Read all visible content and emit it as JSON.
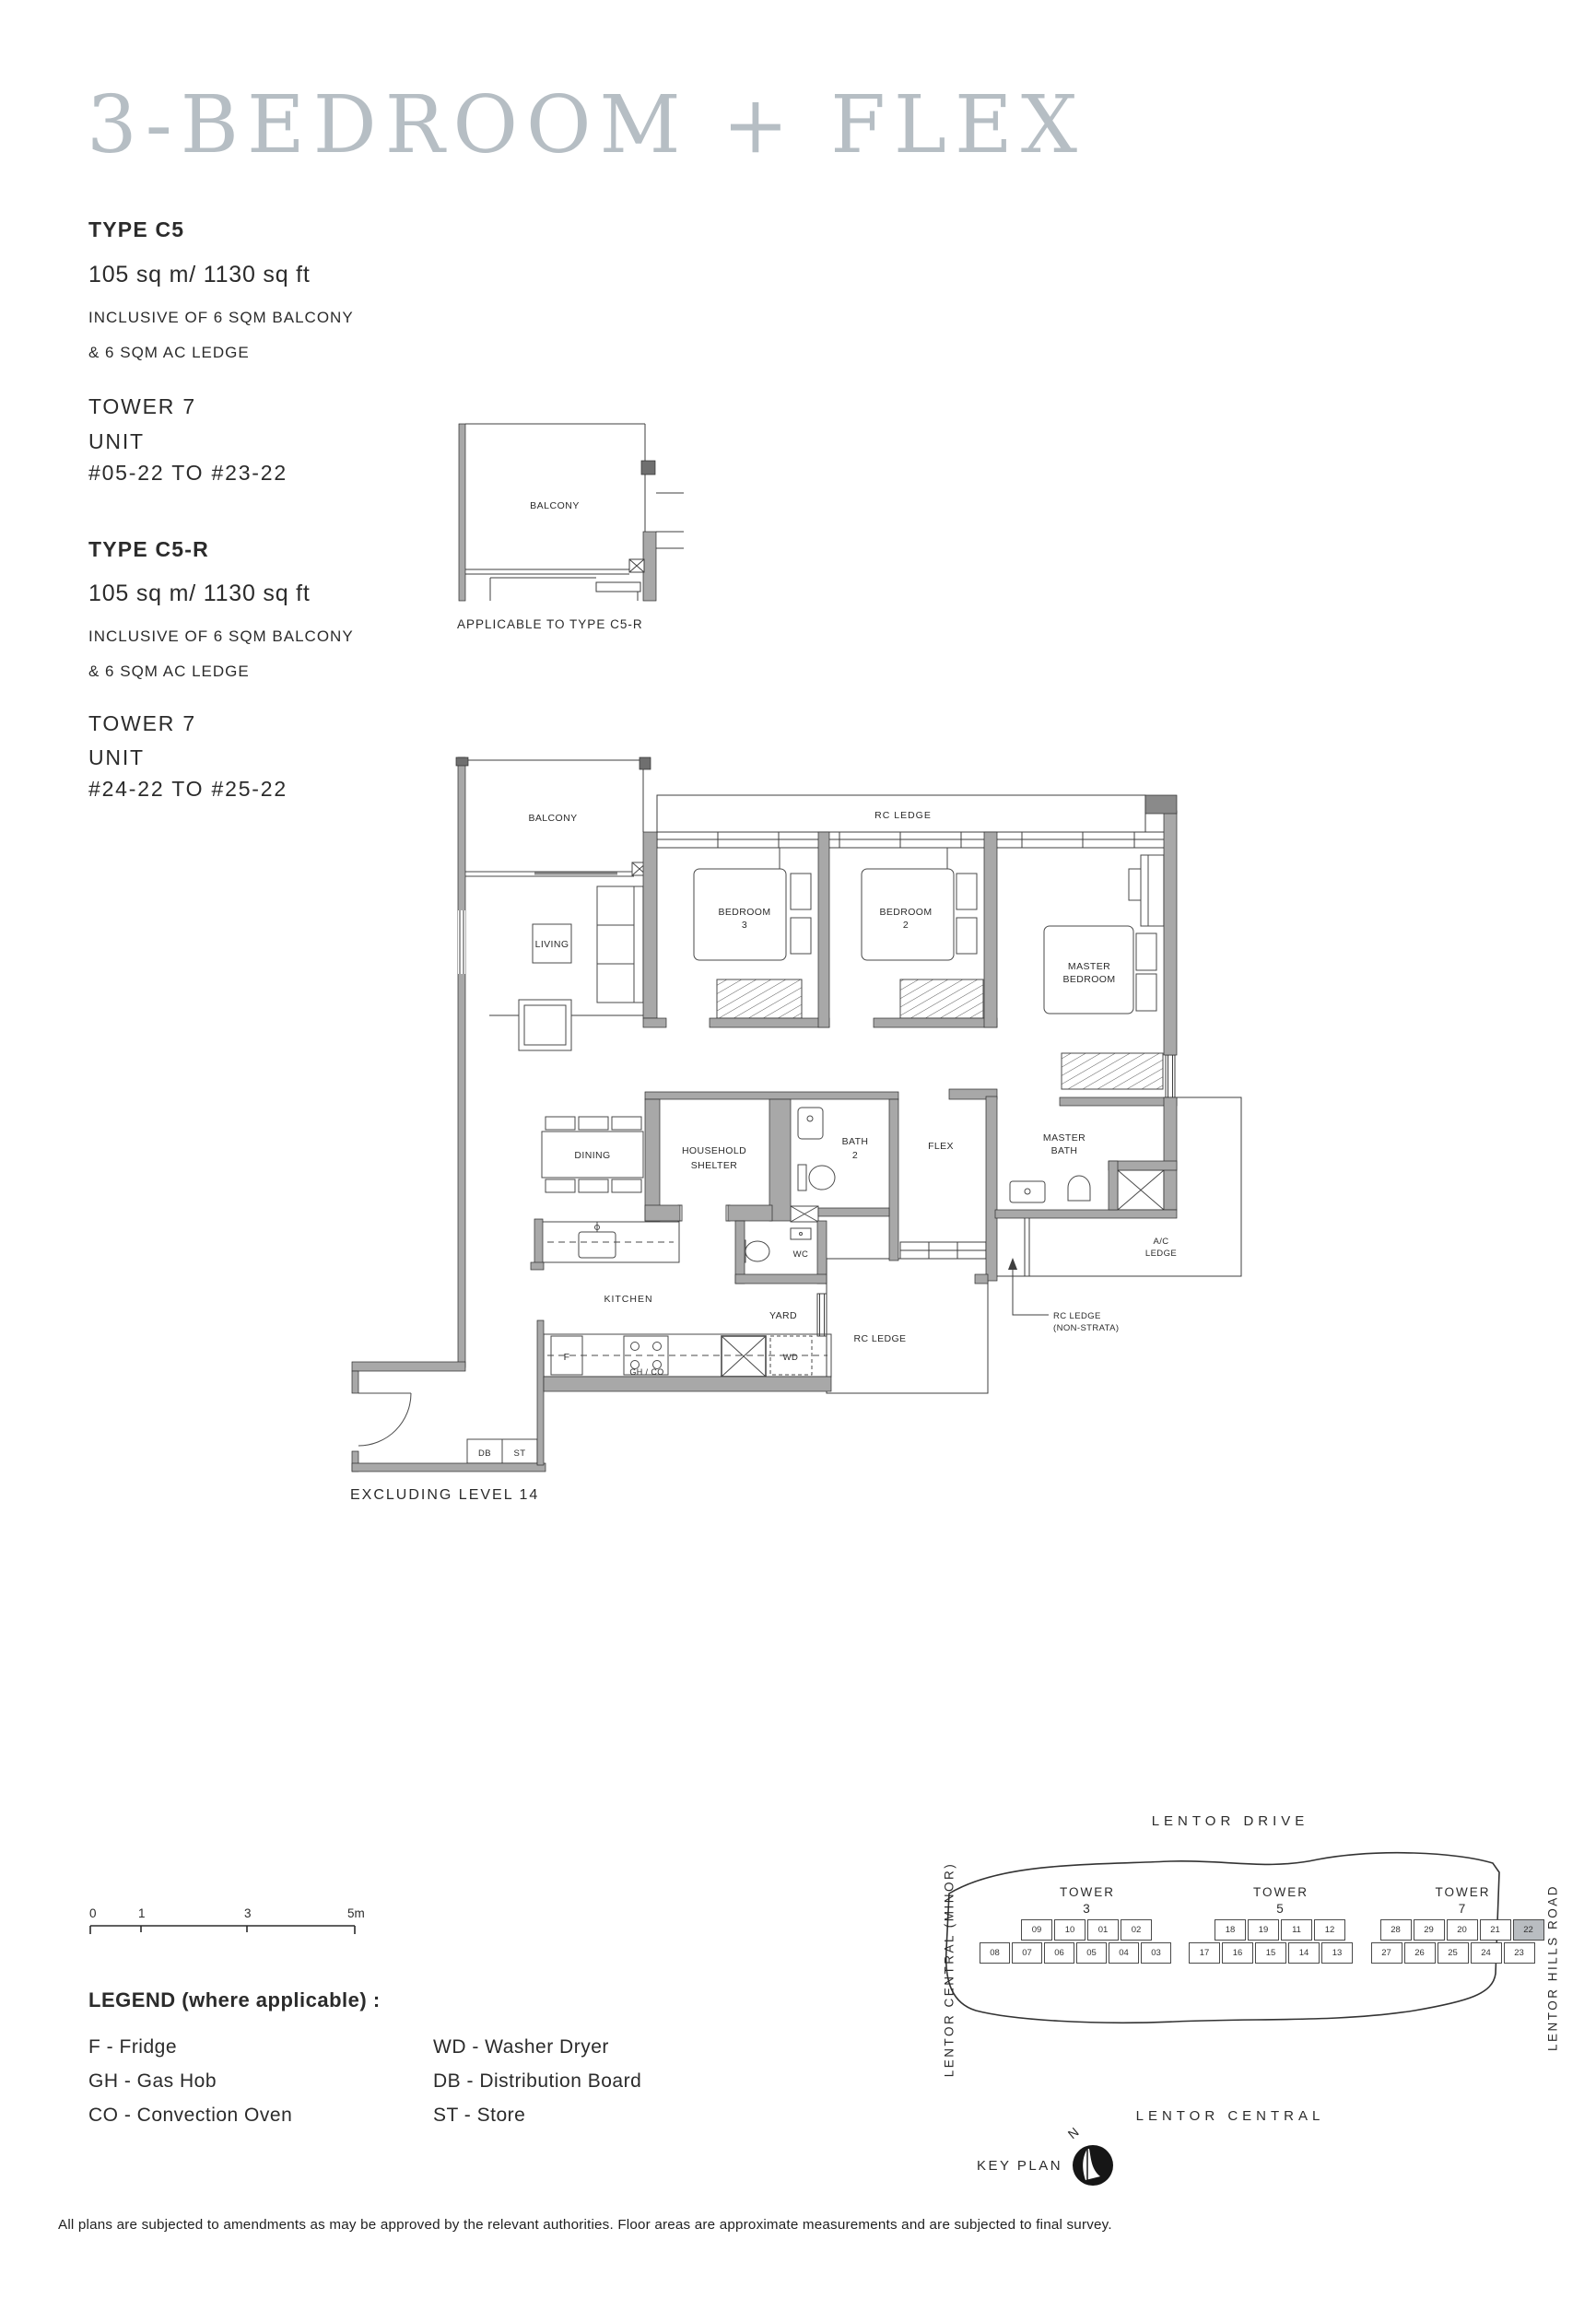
{
  "page": {
    "title": "3-BEDROOM + FLEX",
    "excluding_note": "EXCLUDING LEVEL 14",
    "footer": "All plans are subjected to amendments as may be approved by the relevant authorities. Floor areas are approximate measurements and are subjected to final survey."
  },
  "specs": {
    "c5": {
      "type": "TYPE C5",
      "area": "105 sq m/ 1130 sq ft",
      "inclusive1": "INCLUSIVE OF 6 SQM BALCONY",
      "inclusive2": "& 6 SQM AC LEDGE",
      "tower": "TOWER 7",
      "unit_label": "UNIT",
      "unit_range": "#05-22 TO #23-22"
    },
    "c5r": {
      "type": "TYPE C5-R",
      "area": "105 sq m/ 1130 sq ft",
      "inclusive1": "INCLUSIVE OF 6 SQM BALCONY",
      "inclusive2": "& 6 SQM AC LEDGE",
      "tower": "TOWER 7",
      "unit_label": "UNIT",
      "unit_range": "#24-22 TO #25-22"
    }
  },
  "fragment": {
    "balcony": "BALCONY",
    "caption": "APPLICABLE TO TYPE C5-R"
  },
  "plan": {
    "labels": {
      "balcony": "BALCONY",
      "rc_ledge_top": "RC LEDGE",
      "bedroom3_l1": "BEDROOM",
      "bedroom3_l2": "3",
      "bedroom2_l1": "BEDROOM",
      "bedroom2_l2": "2",
      "master_l1": "MASTER",
      "master_l2": "BEDROOM",
      "living": "LIVING",
      "dining": "DINING",
      "household_l1": "HOUSEHOLD",
      "household_l2": "SHELTER",
      "bath2_l1": "BATH",
      "bath2_l2": "2",
      "flex": "FLEX",
      "masterbath_l1": "MASTER",
      "masterbath_l2": "BATH",
      "ac_l1": "A/C",
      "ac_l2": "LEDGE",
      "wc": "WC",
      "kitchen": "KITCHEN",
      "yard": "YARD",
      "rc_ledge_bottom": "RC LEDGE",
      "rc_ns_l1": "RC LEDGE",
      "rc_ns_l2": "(NON-STRATA)",
      "fridge": "F",
      "ghco": "GH / CO",
      "wd": "WD",
      "db": "DB",
      "st": "ST"
    }
  },
  "scalebar": {
    "t0": "0",
    "t1": "1",
    "t3": "3",
    "t5": "5m"
  },
  "legend": {
    "title": "LEGEND (where applicable) :",
    "col1": [
      "F - Fridge",
      "GH - Gas Hob",
      "CO - Convection Oven"
    ],
    "col2": [
      "WD - Washer Dryer",
      "DB - Distribution Board",
      "ST - Store"
    ]
  },
  "keyplan": {
    "roads": {
      "top": "LENTOR DRIVE",
      "left": "LENTOR CENTRAL (MINOR)",
      "right": "LENTOR HILLS ROAD",
      "bottom": "LENTOR CENTRAL"
    },
    "label": "KEY PLAN",
    "north": "N",
    "highlight_unit": "22",
    "towers": [
      {
        "name": "TOWER",
        "num": "3",
        "row1": [
          "09",
          "10",
          "01",
          "02"
        ],
        "row2": [
          "08",
          "07",
          "06",
          "05",
          "04",
          "03"
        ]
      },
      {
        "name": "TOWER",
        "num": "5",
        "row1": [
          "18",
          "19",
          "11",
          "12"
        ],
        "row2": [
          "17",
          "16",
          "15",
          "14",
          "13"
        ]
      },
      {
        "name": "TOWER",
        "num": "7",
        "row1": [
          "28",
          "29",
          "20",
          "21",
          "22"
        ],
        "row2": [
          "27",
          "26",
          "25",
          "24",
          "23"
        ]
      }
    ]
  },
  "colors": {
    "title": "#b6bec4",
    "wall": "#a8a8a8",
    "line": "#3f3f3f",
    "highlight": "#b9bdc1"
  }
}
